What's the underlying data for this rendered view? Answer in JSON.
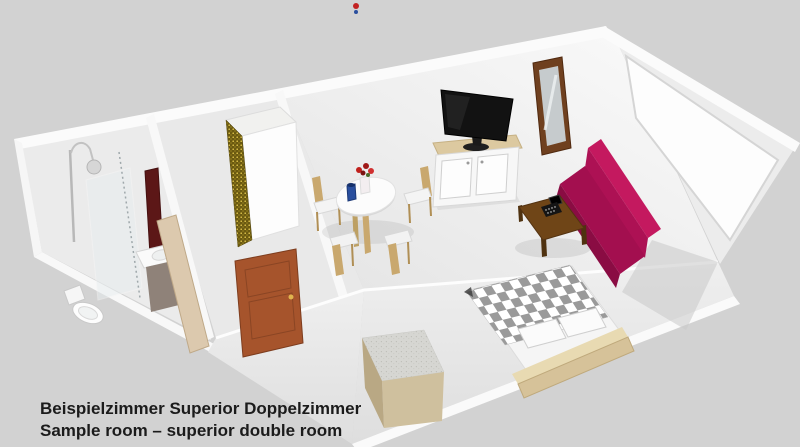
{
  "meta": {
    "kind": "3d-floorplan-render",
    "room_type": "superior double room"
  },
  "caption": {
    "line1": "Beispielzimmer Superior Doppelzimmer",
    "line2": "Sample room – superior double room"
  },
  "room": {
    "areas": [
      {
        "name": "bathroom",
        "features": [
          "shower",
          "glass-panel",
          "toilet",
          "washbasin-cabinet",
          "dark-red-mirror",
          "open-bathroom-door"
        ]
      },
      {
        "name": "entry-hall",
        "features": [
          "brown-entrance-door",
          "white-wardrobe-with-gold-front"
        ]
      },
      {
        "name": "living-sleeping-area",
        "features": [
          "round-dining-table",
          "four-wooden-chairs",
          "flower-vase",
          "blue-cup",
          "tv-on-sideboard",
          "wall-mirror",
          "berry-red-sofa",
          "coffee-table-with-laptop",
          "double-bed-checkered-blanket",
          "two-pillows",
          "beige-headboard",
          "beige-ottoman",
          "large-window-right-wall"
        ]
      }
    ]
  },
  "colors": {
    "background": "#d2d2d2",
    "wall": "#fafafa",
    "floor": "#ececec",
    "window_pane": "#fdfdfd",
    "sofa": "#a30f4f",
    "sofa_dark": "#8a0c43",
    "entrance_door": "#a6542c",
    "bathroom_door": "#dcc9ae",
    "coffee_table": "#6f4517",
    "tv_screen": "#121212",
    "sideboard_top": "#dcc9a0",
    "bed_headboard": "#d6c299",
    "blanket_gray": "#9a9a9a",
    "bath_mirror": "#5c1717",
    "wardrobe_gold": "#6b5a10",
    "ottoman_front": "#cfc09e",
    "caption_text": "#1b1b1b"
  }
}
